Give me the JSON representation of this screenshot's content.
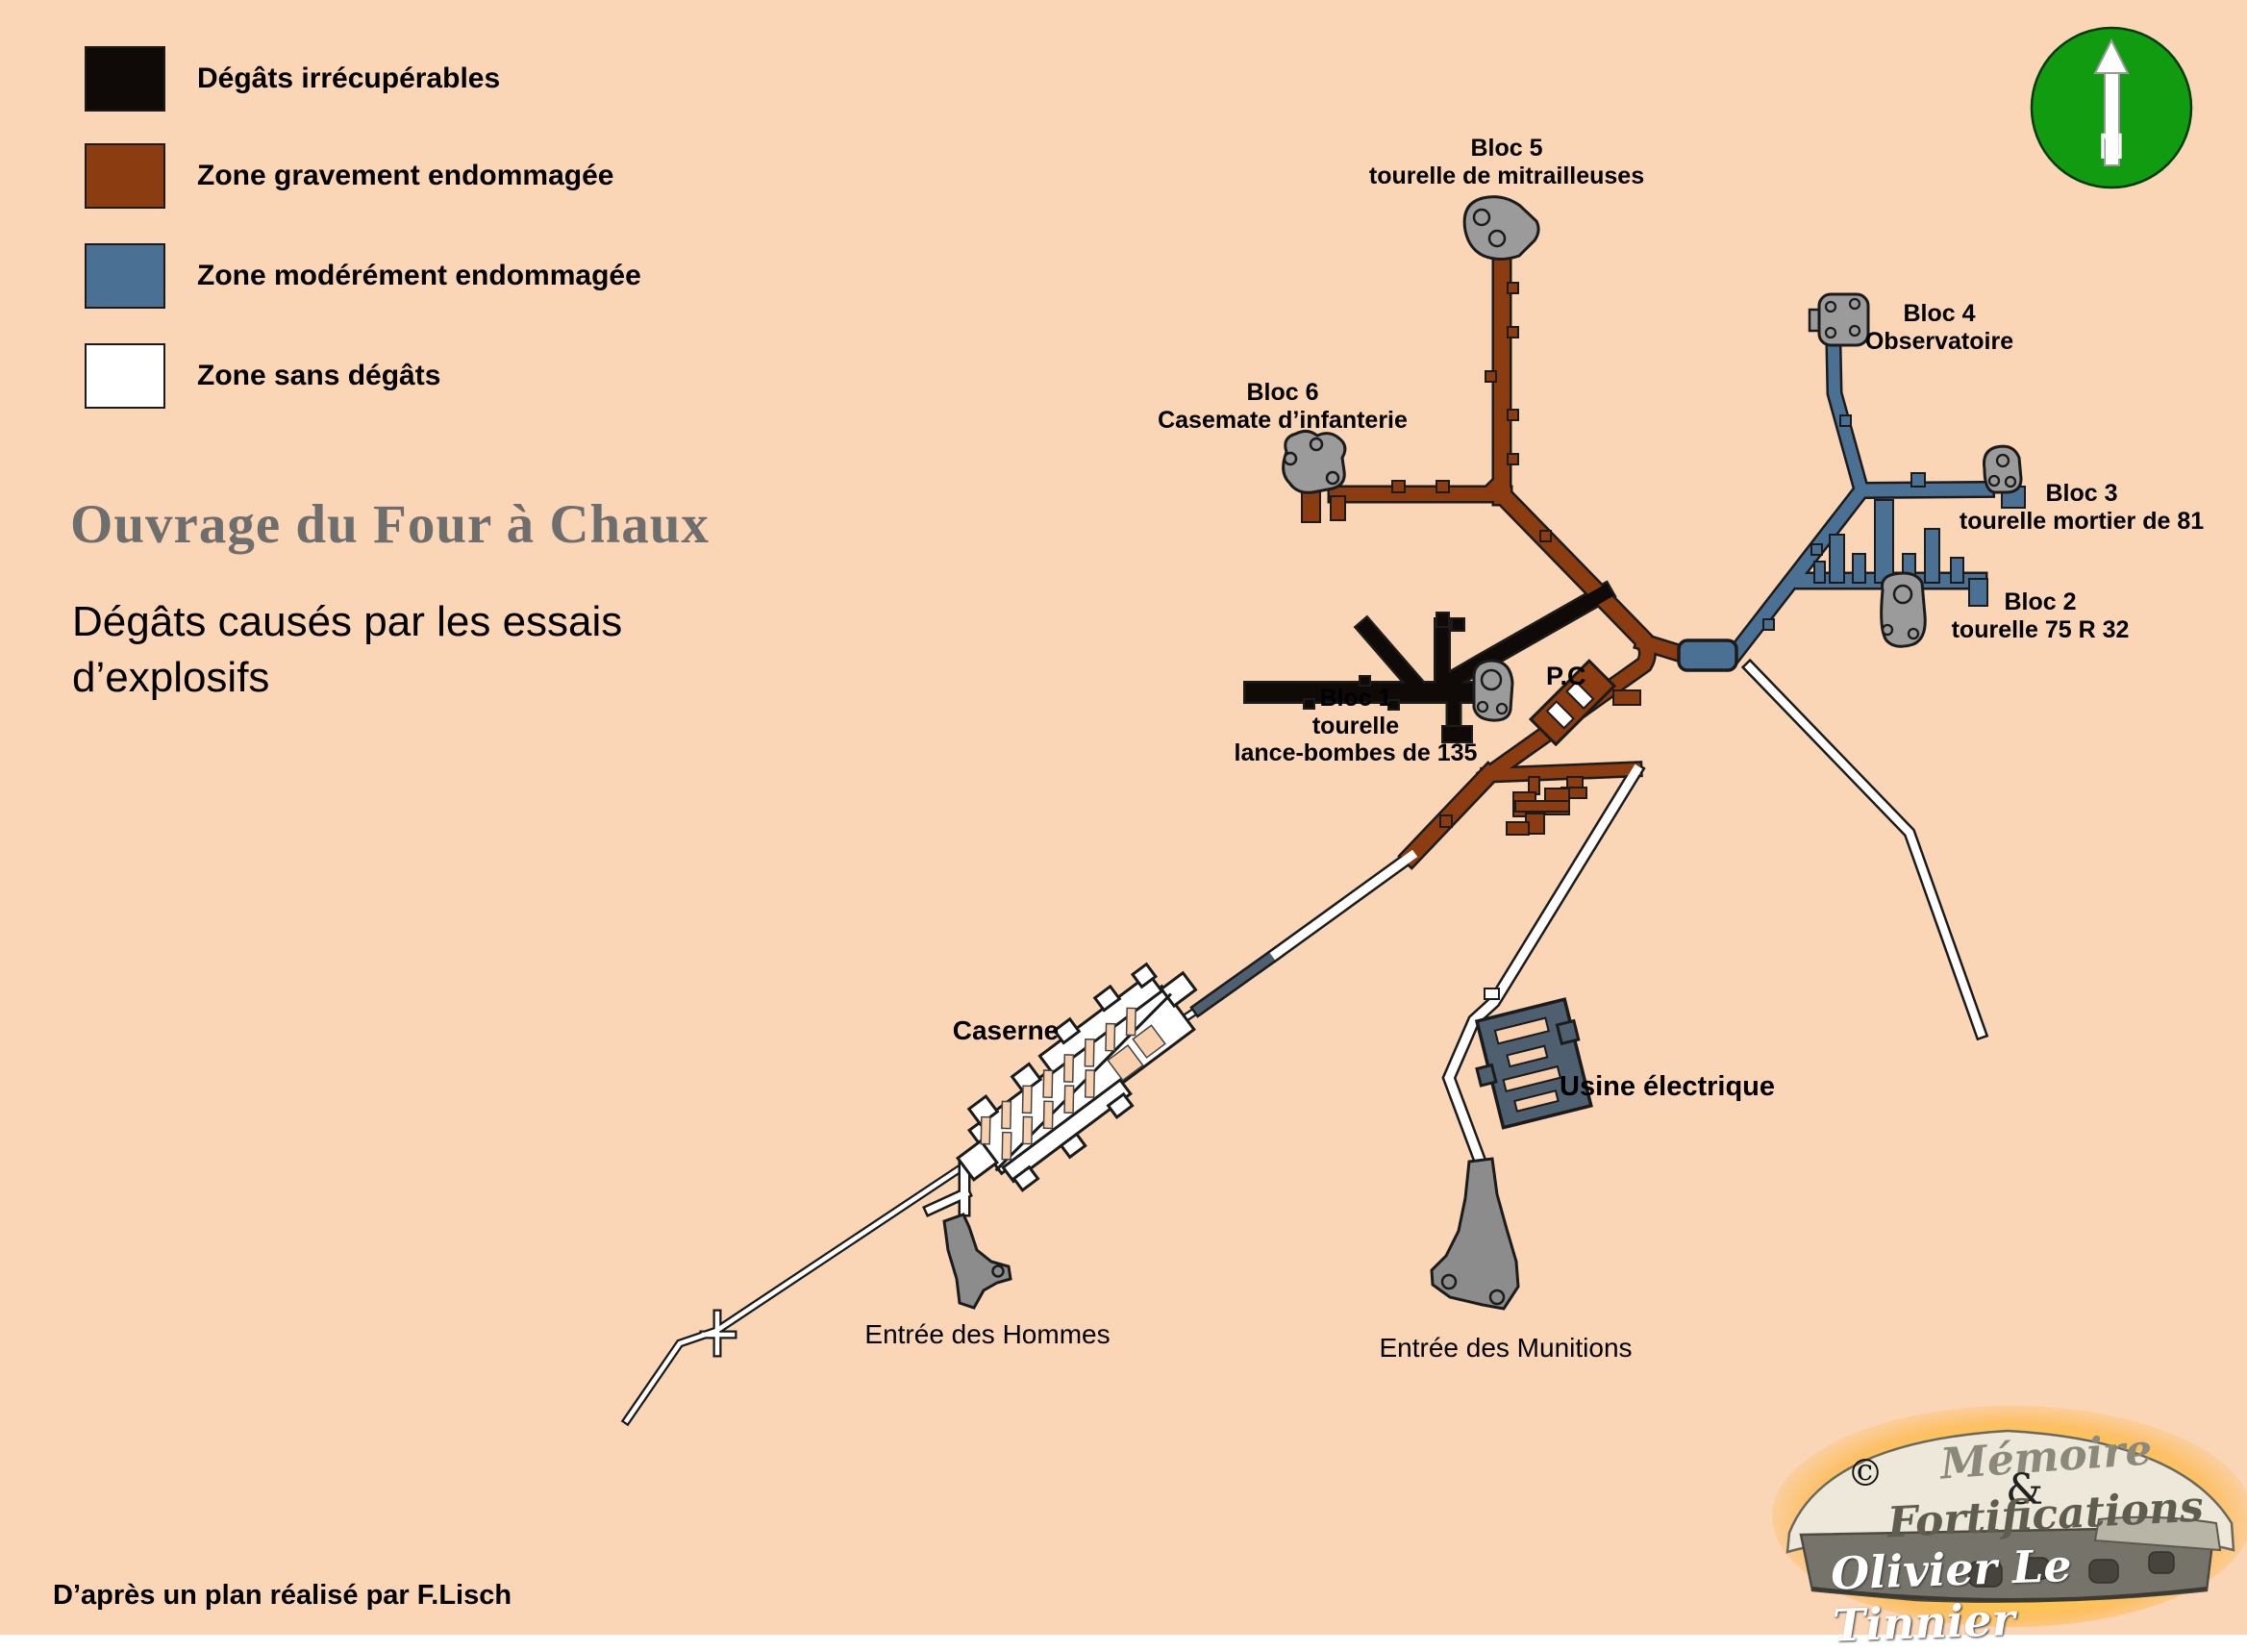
{
  "colors": {
    "background": "#FAD5B6",
    "irrecoverable_black": "#0F0A07",
    "severe_brown": "#8B3C10",
    "moderate_blue": "#4A7194",
    "no_damage_white": "#FFFFFF",
    "dark_slate": "#4E5F70",
    "turret_gray": "#9B9B9B",
    "entrance_gray": "#8C8C8C",
    "outline": "#1B1B1B",
    "north_green": "#109B10",
    "title_gray": "#6E6E6E"
  },
  "legend": {
    "items": [
      {
        "id": "irrecoverable",
        "label": "Dégâts irrécupérables",
        "color": "#0F0A07"
      },
      {
        "id": "severe",
        "label": "Zone gravement endommagée",
        "color": "#8B3C10"
      },
      {
        "id": "moderate",
        "label": "Zone modérément endommagée",
        "color": "#4A7194"
      },
      {
        "id": "none",
        "label": "Zone sans dégâts",
        "color": "#FFFFFF"
      }
    ]
  },
  "title": "Ouvrage du Four à Chaux",
  "subtitle": {
    "l1": "Dégâts causés par les essais",
    "l2": "d’explosifs"
  },
  "north": {
    "label": "N"
  },
  "map": {
    "labels": {
      "bloc5": {
        "l1": "Bloc 5",
        "l2": "tourelle de mitrailleuses"
      },
      "bloc6": {
        "l1": "Bloc 6",
        "l2": "Casemate d’infanterie"
      },
      "bloc4": {
        "l1": "Bloc 4",
        "l2": "Observatoire"
      },
      "bloc3": {
        "l1": "Bloc 3",
        "l2": "tourelle mortier de 81"
      },
      "bloc2": {
        "l1": "Bloc 2",
        "l2": "tourelle 75 R 32"
      },
      "bloc1": {
        "l1": "Bloc 1",
        "l2": "tourelle",
        "l3": "lance-bombes de 135"
      },
      "pc": "P.C",
      "caserne": "Caserne",
      "usine": "Usine électrique",
      "entree_hommes": "Entrée des Hommes",
      "entree_munitions": "Entrée des Munitions"
    }
  },
  "footer": {
    "credit": "D’après un plan réalisé par F.Lisch"
  },
  "logo": {
    "copyright": "©",
    "word1": "Mémoire",
    "amp": "&",
    "word2": "Fortifications",
    "author": "Olivier Le Tinnier"
  }
}
